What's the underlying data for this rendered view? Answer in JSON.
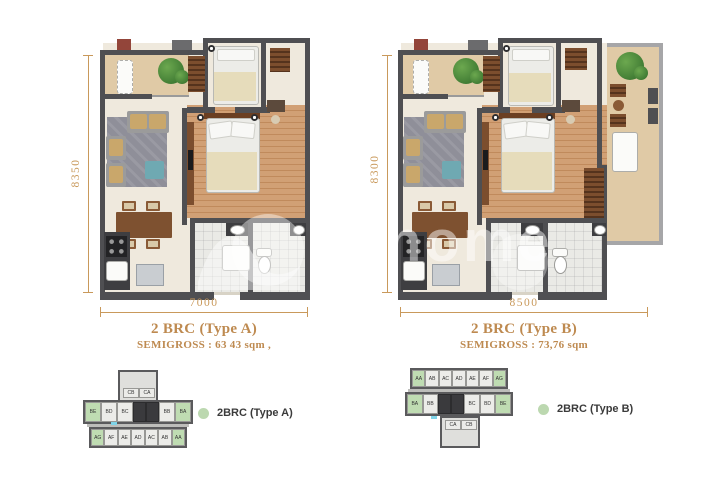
{
  "plans": [
    {
      "title": "2 BRC (Type A)",
      "subtitle": "SEMIGROSS : 63 43 sqm ,",
      "width_label": "7000",
      "height_label": "8350",
      "legend_label": "2BRC (Type A)"
    },
    {
      "title": "2 BRC (Type B)",
      "subtitle": "SEMIGROSS : 73,76 sqm",
      "width_label": "8500",
      "height_label": "8300",
      "legend_label": "2BRC (Type B)"
    }
  ],
  "keyplan_a": {
    "tower": [
      "CB",
      "CA"
    ],
    "row_b": [
      "BE",
      "BD",
      "BC",
      "BB",
      "BA"
    ],
    "row_a": [
      "AG",
      "AF",
      "AE",
      "AD",
      "AC",
      "AB",
      "AA"
    ]
  },
  "keyplan_b": {
    "row_a": [
      "AA",
      "AB",
      "AC",
      "AD",
      "AE",
      "AF",
      "AG"
    ],
    "row_b": [
      "BA",
      "BB",
      "BC",
      "BD",
      "BE"
    ],
    "tower": [
      "CA",
      "CB"
    ]
  },
  "watermark": {
    "text": "home"
  },
  "colors": {
    "dimension": "#C9995B",
    "title": "#BE8A50",
    "legend_dot": "#BCD8B0",
    "wall": "#4F4F52",
    "balcony_tile": "#E0CAA6",
    "wood_floor": "#C8956A",
    "highlight_unit": "#BFDCB2"
  }
}
